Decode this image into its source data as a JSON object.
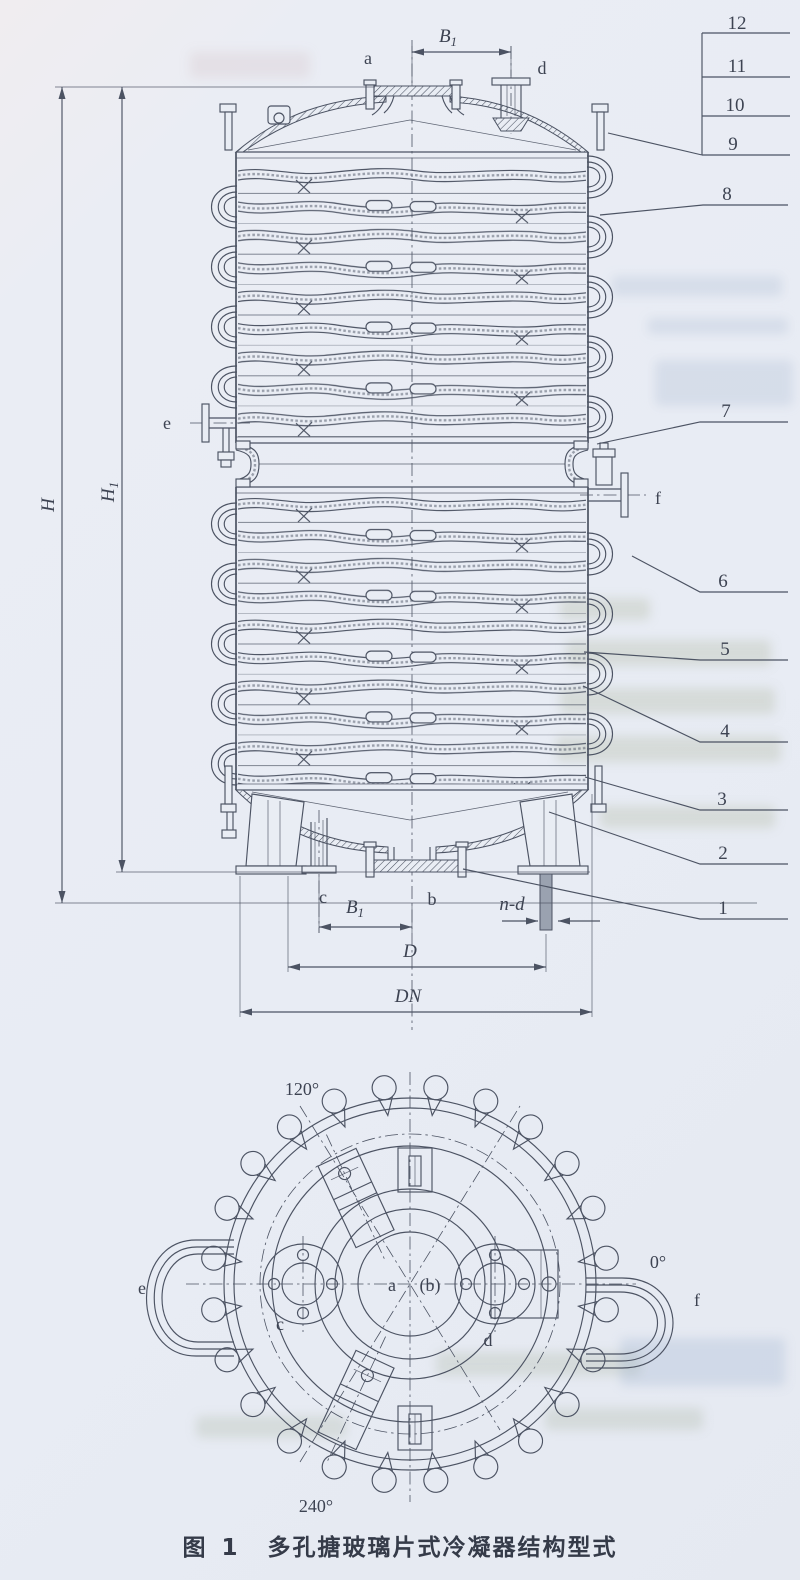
{
  "figure_caption": {
    "prefix": "图 1",
    "title": "多孔搪玻璃片式冷凝器结构型式"
  },
  "colors": {
    "paper": "#e9edf4",
    "ink": "#4c5363",
    "label_text": "#3d4352",
    "anchor_bolt_fill": "#9aa2b0"
  },
  "elevation": {
    "part_numbers": [
      "12",
      "11",
      "10",
      "9",
      "8",
      "7",
      "6",
      "5",
      "4",
      "3",
      "2",
      "1"
    ],
    "nozzles": {
      "a": "a",
      "b": "b",
      "c": "c",
      "d": "d",
      "e": "e",
      "f": "f"
    },
    "dims": {
      "b1": {
        "main": "B",
        "sub": "1"
      },
      "h": "H",
      "h1": {
        "main": "H",
        "sub": "1"
      },
      "d": "D",
      "dn": "DN",
      "nd": "n-d"
    }
  },
  "plan": {
    "angles": {
      "deg120": "120°",
      "deg0": "0°",
      "deg240": "240°"
    },
    "labels": {
      "a": "a",
      "b": "(b)",
      "c": "c",
      "d": "d",
      "e": "e",
      "f": "f"
    }
  }
}
